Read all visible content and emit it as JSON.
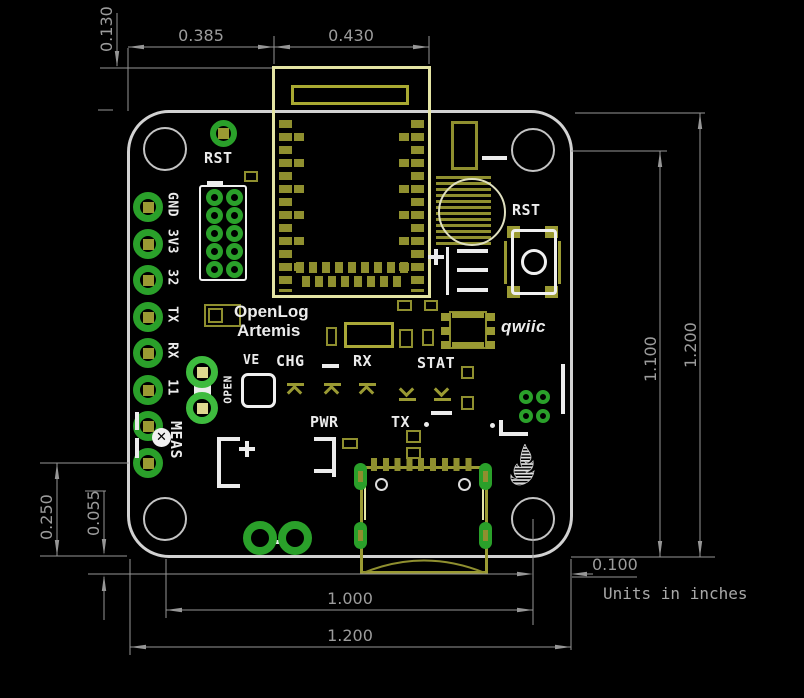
{
  "drawing": {
    "units_note": "Units in inches",
    "dimensions": {
      "module_top_offset": "0.130",
      "edge_to_module": "0.385",
      "module_width": "0.430",
      "pin_row_to_bottom": "0.250",
      "card_overhang": "0.055",
      "hole_spacing_horizontal": "1.000",
      "board_width": "1.200",
      "hole_center_to_edge": "0.100",
      "hole_to_bottom_edge": "1.100",
      "board_height": "1.200"
    }
  },
  "silkscreen": {
    "rst_top": "RST",
    "rst_button": "RST",
    "product_line1": "OpenLog",
    "product_line2": "Artemis",
    "ve_jumper": "VE",
    "chg_led": "CHG",
    "rx_led": "RX",
    "stat_led": "STAT",
    "pwr_led": "PWR",
    "tx_led": "TX",
    "meas_jumper": "MEAS",
    "open_label": "OPEN",
    "qwiic_logo": "qwiic",
    "pins": [
      "GND",
      "3V3",
      "32",
      "TX",
      "RX",
      "11"
    ]
  },
  "colors": {
    "background": "#000000",
    "board_outline": "#d2d2d2",
    "pad_green": "#2aa02a",
    "copper_olive": "#8f8f2f",
    "module_yellow": "#e4e4a4",
    "silk_white": "#ececec",
    "dimension_gray": "#969696"
  }
}
